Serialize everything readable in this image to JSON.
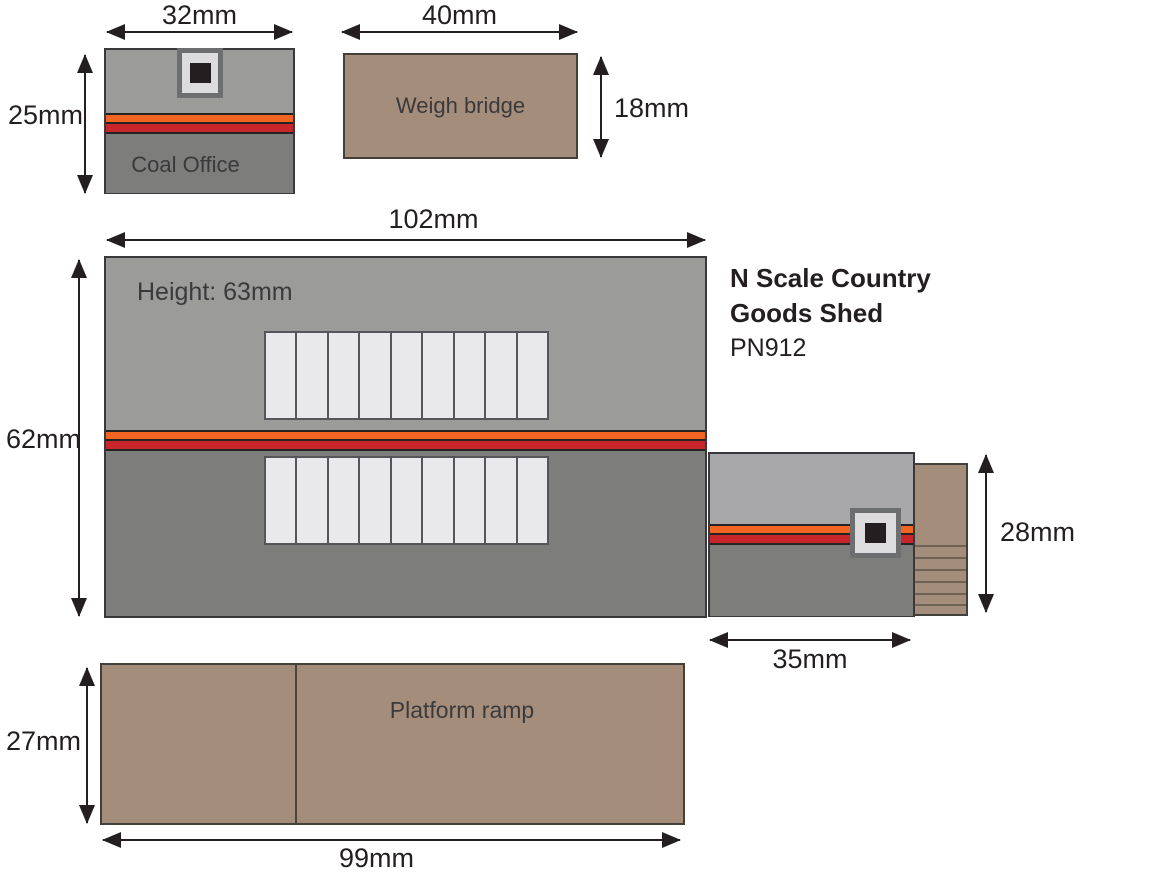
{
  "title_block": {
    "line1": "N Scale Country",
    "line2": "Goods Shed",
    "product_code": "PN912"
  },
  "coal_office": {
    "label": "Coal Office",
    "width_dim": "32mm",
    "height_dim": "25mm"
  },
  "weigh_bridge": {
    "label": "Weigh bridge",
    "width_dim": "40mm",
    "height_dim": "18mm"
  },
  "goods_shed": {
    "height_note": "Height: 63mm",
    "width_dim": "102mm",
    "height_dim": "62mm"
  },
  "side_extension": {
    "width_dim": "35mm",
    "height_dim": "28mm"
  },
  "platform_ramp": {
    "label": "Platform ramp",
    "width_dim": "99mm",
    "height_dim": "27mm"
  },
  "counts": {
    "roof_slats_per_row": 9,
    "extension_step_lines": 6
  },
  "colors": {
    "roof_gray_light": "#9b9b9a",
    "roof_gray_dark": "#7d7d7c",
    "extension_gray": "#a8a8aa",
    "stripe_orange": "#f26522",
    "stripe_red": "#c9262c",
    "brown": "#a58d7b",
    "slat_fill": "#e9e9eb",
    "outline": "#231f20"
  }
}
